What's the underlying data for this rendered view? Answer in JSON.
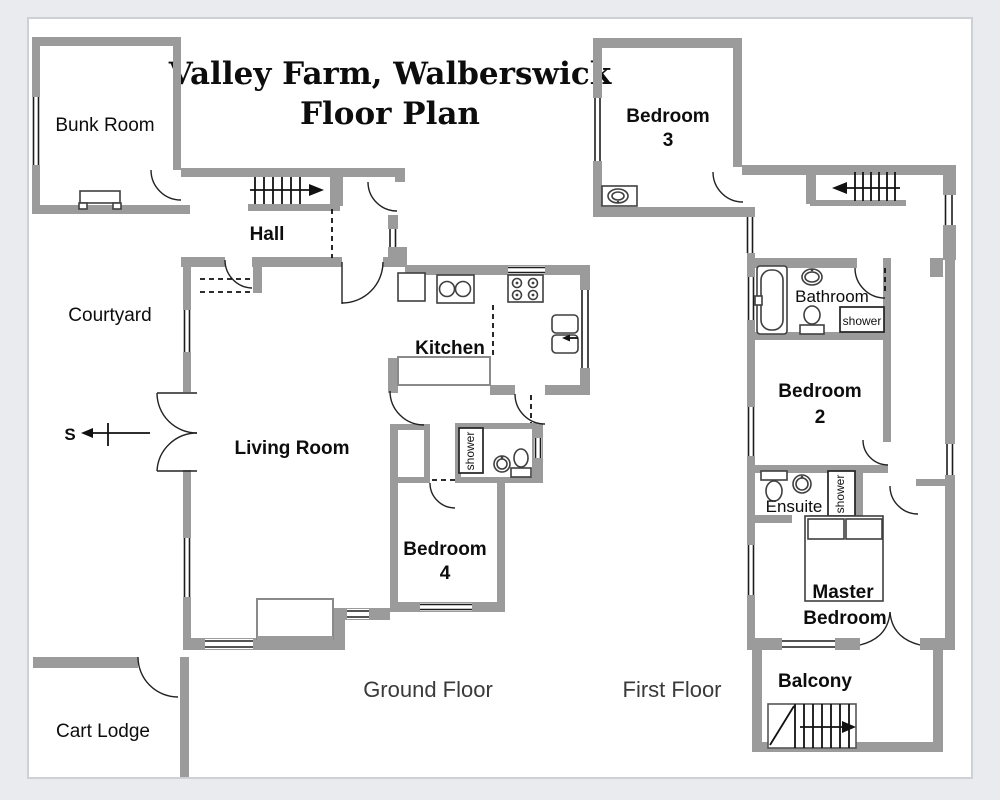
{
  "title": {
    "line1": "Valley Farm, Walberswick",
    "line2": "Floor Plan"
  },
  "compass": {
    "south_label": "S"
  },
  "floors": {
    "ground": {
      "caption": "Ground Floor",
      "labels": {
        "bunk_room": "Bunk Room",
        "hall": "Hall",
        "courtyard": "Courtyard",
        "kitchen": "Kitchen",
        "living_room": "Living Room",
        "bedroom4_l1": "Bedroom",
        "bedroom4_l2": "4",
        "shower": "shower",
        "cart_lodge": "Cart Lodge"
      }
    },
    "first": {
      "caption": "First Floor",
      "labels": {
        "bedroom3_l1": "Bedroom",
        "bedroom3_l2": "3",
        "bathroom": "Bathroom",
        "bathroom_shower": "shower",
        "bedroom2_l1": "Bedroom",
        "bedroom2_l2": "2",
        "ensuite": "Ensuite",
        "ensuite_shower": "shower",
        "master_l1": "Master",
        "master_l2": "Bedroom",
        "balcony": "Balcony"
      }
    }
  },
  "colors": {
    "wall": "#9b9b9b",
    "fixture_stroke": "#3f3f3f",
    "page_background": "#e9ebee",
    "canvas": "#ffffff"
  }
}
